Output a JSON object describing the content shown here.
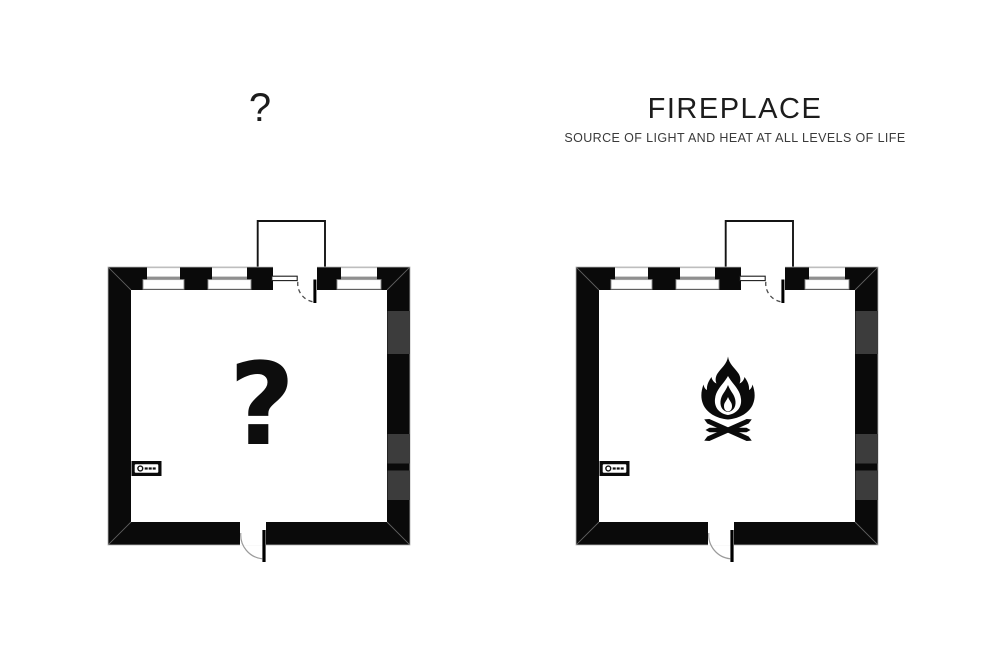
{
  "page": {
    "background_color": "#ffffff"
  },
  "panels": [
    {
      "id": "unknown-room",
      "title": "?",
      "room_symbol": "?",
      "symbol_name": "question-mark-symbol"
    },
    {
      "id": "fireplace-room",
      "title": "FIREPLACE",
      "subtitle": "SOURCE OF LIGHT AND HEAT AT ALL LEVELS OF LIFE",
      "symbol_name": "campfire-icon"
    }
  ],
  "plan_features": {
    "windows_per_plan": 3,
    "doors_per_plan": 2,
    "wall_fixture_icon": "switch-icon"
  },
  "colors": {
    "wall": "#0a0a0a",
    "wall_segment_gray": "#3c3c3c",
    "text": "#1c1c1c",
    "background": "#ffffff"
  }
}
